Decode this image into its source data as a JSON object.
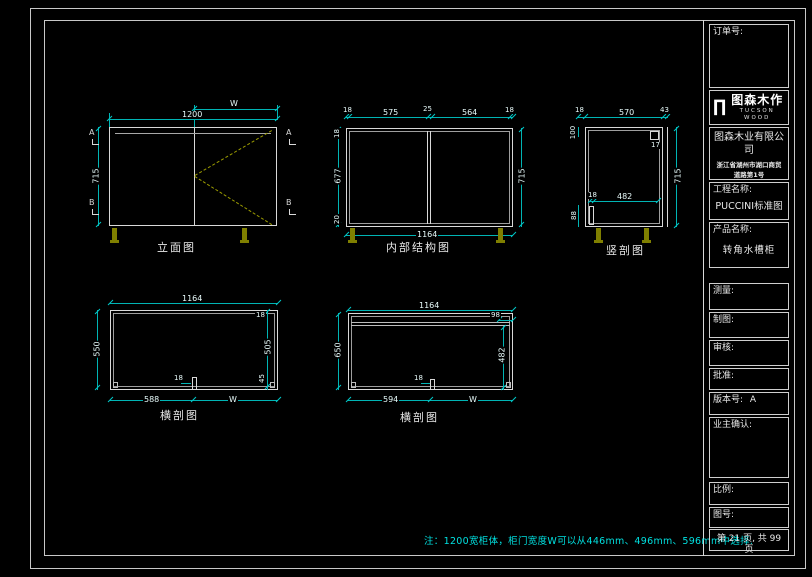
{
  "title_block": {
    "order_label": "订单号:",
    "logo": {
      "mark": "∏",
      "name": "图森木作",
      "sub": "TUCSON WOOD"
    },
    "company_name": "图森木业有限公司",
    "company_address_line1": "浙江省湖州市湖口商贸",
    "company_address_line2": "道路第1号",
    "project_label": "工程名称:",
    "project_name": "PUCCINI标准图",
    "product_label": "产品名称:",
    "product_name": "转角水槽柜",
    "survey_label": "测量:",
    "draft_label": "制图:",
    "review_label": "审核:",
    "approve_label": "批准:",
    "version_label": "版本号:",
    "version_value": "A",
    "owner_label": "业主确认:",
    "scale_label": "比例:",
    "drawing_no_label": "图号:",
    "page_info": "第 21 页, 共 99 页"
  },
  "note": "注：1200宽柜体，柜门宽度W可以从446mm、496mm、596mm中选择.",
  "drawings": {
    "elevation": {
      "label": "立面图",
      "dim_door_width": "W",
      "dim_width": "1200",
      "dim_height": "715",
      "marker_top": "A",
      "marker_bottom": "B"
    },
    "internal": {
      "label": "内部结构图",
      "dim_top": [
        "18",
        "575",
        "25",
        "564",
        "18"
      ],
      "dim_left_top": "18",
      "dim_left": "677",
      "dim_left_bottom": "20",
      "dim_right": "715",
      "dim_bottom": "1164"
    },
    "vertical_section": {
      "label": "竖剖图",
      "dim_top": [
        "18",
        "570",
        "43"
      ],
      "dim_rail": "17",
      "dim_right": "715",
      "dim_mid_left": "18",
      "dim_mid": "482",
      "dim_left_top": "100",
      "dim_left_bottom": "88"
    },
    "cross_section_a": {
      "label": "横剖图",
      "dim_top": "1164",
      "dim_left": "550",
      "dim_right": [
        "18",
        "505",
        "45"
      ],
      "dim_center": "18",
      "dim_bottom_left": "588",
      "dim_bottom_right": "W"
    },
    "cross_section_b": {
      "label": "横剖图",
      "dim_top": "1164",
      "dim_top_right": "98",
      "dim_left": "650",
      "dim_right": "482",
      "dim_center": "18",
      "dim_bottom_left": "594",
      "dim_bottom_right": "W"
    }
  }
}
